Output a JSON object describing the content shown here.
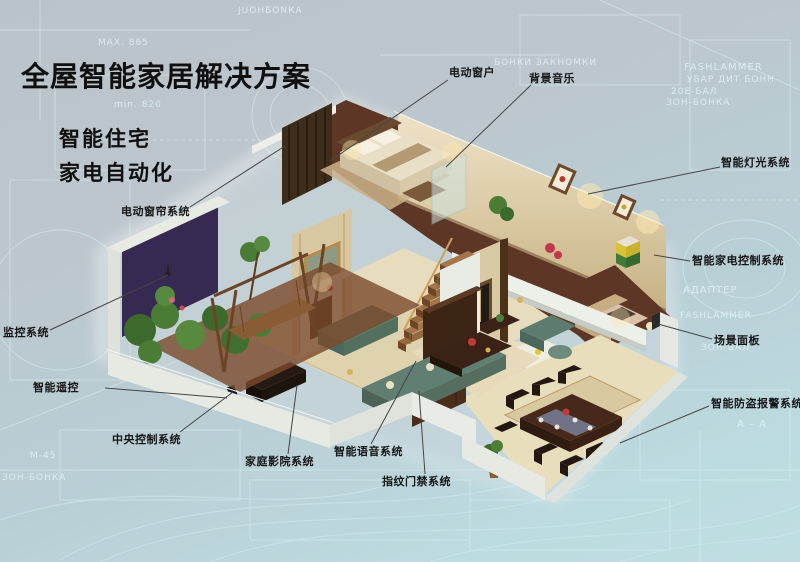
{
  "title": "全屋智能家居解决方案",
  "subtitles": [
    "智能住宅",
    "家电自动化"
  ],
  "colors": {
    "background_top": "#bac3c9",
    "background_bottom": "#c0dee2",
    "blueprint_line": "#d9f0f6",
    "label_text": "#161616",
    "leader_line": "#454545",
    "sofa_teal": "#557262",
    "floor_wood": "#5e3626",
    "wall_beige": "#e0d2b2",
    "accent_purple": "#362a52",
    "plant_green": "#4a7c36"
  },
  "callouts": [
    {
      "id": "electric-window",
      "label": "电动窗户",
      "x": 449,
      "y": 64,
      "line": [
        448,
        80,
        330,
        161
      ]
    },
    {
      "id": "background-music",
      "label": "背景音乐",
      "x": 529,
      "y": 70,
      "line": [
        531,
        85,
        446,
        167
      ]
    },
    {
      "id": "smart-lighting",
      "label": "智能灯光系统",
      "x": 721,
      "y": 154,
      "line": [
        720,
        167,
        588,
        194
      ]
    },
    {
      "id": "smart-appliance-control",
      "label": "智能家电控制系统",
      "x": 692,
      "y": 252,
      "line": [
        690,
        261,
        654,
        255
      ]
    },
    {
      "id": "scene-panel",
      "label": "场景面板",
      "x": 714,
      "y": 332,
      "line": [
        712,
        339,
        658,
        324
      ]
    },
    {
      "id": "burglar-alarm",
      "label": "智能防盗报警系统",
      "x": 711,
      "y": 395,
      "line": [
        709,
        406,
        620,
        443
      ]
    },
    {
      "id": "electric-curtain",
      "label": "电动窗帘系统",
      "x": 121,
      "y": 203,
      "line": [
        190,
        207,
        285,
        146
      ]
    },
    {
      "id": "monitoring",
      "label": "监控系统",
      "x": 3,
      "y": 324,
      "line": [
        50,
        330,
        168,
        275
      ]
    },
    {
      "id": "smart-remote",
      "label": "智能遥控",
      "x": 33,
      "y": 379,
      "line": [
        105,
        388,
        227,
        398
      ]
    },
    {
      "id": "central-control",
      "label": "中央控制系统",
      "x": 112,
      "y": 431,
      "line": [
        180,
        432,
        233,
        392
      ]
    },
    {
      "id": "home-theater",
      "label": "家庭影院系统",
      "x": 245,
      "y": 453,
      "line": [
        288,
        454,
        297,
        385
      ]
    },
    {
      "id": "smart-voice",
      "label": "智能语音系统",
      "x": 334,
      "y": 443,
      "line": [
        371,
        444,
        416,
        361
      ]
    },
    {
      "id": "fingerprint-access",
      "label": "指纹门禁系统",
      "x": 382,
      "y": 473,
      "line": [
        425,
        474,
        419,
        391
      ]
    }
  ],
  "background_texts": [
    {
      "text": "МАХ. 865",
      "x": 98,
      "y": 38,
      "size": 9
    },
    {
      "text": "min. 820",
      "x": 114,
      "y": 100,
      "size": 9
    },
    {
      "text": "JUОНБОNКА",
      "x": 238,
      "y": 6,
      "size": 9
    },
    {
      "text": "БОНКИ ЗАКНОМКИ",
      "x": 494,
      "y": 58,
      "size": 9
    },
    {
      "text": "FASHLAMMER",
      "x": 684,
      "y": 62,
      "size": 10
    },
    {
      "text": "УБАР ДИТ БОНН",
      "x": 687,
      "y": 75,
      "size": 9
    },
    {
      "text": "20Е-БАЛ",
      "x": 671,
      "y": 87,
      "size": 9
    },
    {
      "text": "ЗОН-БОНКА",
      "x": 666,
      "y": 98,
      "size": 9
    },
    {
      "text": "АДАПТЕР",
      "x": 683,
      "y": 285,
      "size": 10
    },
    {
      "text": "FASHLAMMER",
      "x": 680,
      "y": 311,
      "size": 9
    },
    {
      "text": "ЗОН-БАЛ",
      "x": 701,
      "y": 343,
      "size": 9
    },
    {
      "text": "A – A",
      "x": 737,
      "y": 419,
      "size": 10
    },
    {
      "text": "ЗОН-БОНКА",
      "x": 2,
      "y": 473,
      "size": 9
    },
    {
      "text": "М-45",
      "x": 30,
      "y": 451,
      "size": 9
    }
  ],
  "illustration": {
    "name": "isometric-smart-home-cutaway",
    "elements": [
      "master-bedroom",
      "guest-bedroom",
      "living-room",
      "dining-room",
      "kitchen",
      "balcony-garden",
      "staircase",
      "entry-door",
      "fireplace",
      "swing",
      "plants",
      "fridge"
    ]
  }
}
